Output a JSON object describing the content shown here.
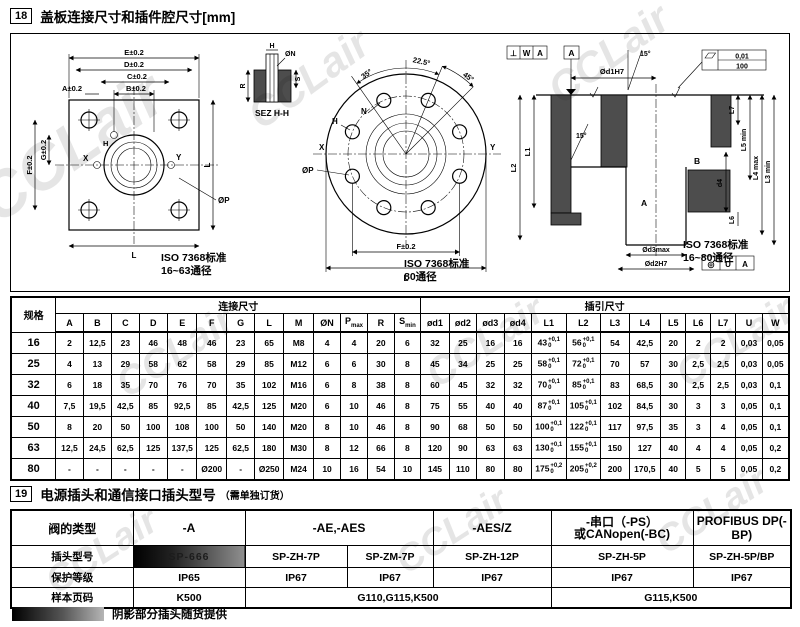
{
  "watermark": "CCLair",
  "header18": {
    "num": "18",
    "title": "盖板连接尺寸和插件腔尺寸[mm]"
  },
  "header19": {
    "num": "19",
    "title": "电源插头和通信接口插头型号",
    "subtitle": "（需单独订货）"
  },
  "figures": {
    "fig1": {
      "E": "E±0.2",
      "D": "D±0.2",
      "C": "C±0.2",
      "B": "B±0.2",
      "A": "A±0.2",
      "F": "F±0.2",
      "G": "G±0.2",
      "H": "H",
      "Lr": "L",
      "Lb": "L",
      "X": "X",
      "Y": "Y",
      "P": "ØP",
      "caption1": "ISO 7368标准",
      "caption2": "16~63通径",
      "sez": {
        "title": "SEZ H-H",
        "H": "H",
        "N": "ØN",
        "R": "R",
        "S": "S"
      }
    },
    "fig2": {
      "a35": "35°",
      "a225": "22.5°",
      "a45": "45°",
      "H": "H",
      "N": "N",
      "X": "X",
      "Y": "Y",
      "P": "ØP",
      "F": "F±0.2",
      "L": "L",
      "caption1": "ISO 7368标准",
      "caption2": "80通径"
    },
    "fig3": {
      "d1": "Ød1H7",
      "datumA": "A",
      "perp": "⊥",
      "W": "W",
      "dA2": "A",
      "conc": "◎",
      "U": "U",
      "dA3": "A",
      "flat1": "0,01",
      "flat2": "100",
      "a15a": "15°",
      "a15b": "15°",
      "L1": "L1",
      "L2": "L2",
      "L3": "L3 min",
      "L4": "L4 max",
      "L5": "L5 min",
      "L7": "L7",
      "d4": "d4",
      "L6": "L6",
      "B": "B",
      "A": "A",
      "d3": "Ød3max",
      "d2": "Ød2H7",
      "caption1": "ISO 7368标准",
      "caption2": "16~80通径"
    }
  },
  "table1": {
    "spec": "规格",
    "group1": "连接尺寸",
    "group2": "插引尺寸",
    "columns": [
      "A",
      "B",
      "C",
      "D",
      "E",
      "F",
      "G",
      "L",
      "M",
      "ØN",
      [
        "P",
        "max"
      ],
      "R",
      [
        "S",
        "min"
      ],
      "ød1",
      "ød2",
      "ød3",
      "ød4",
      "L1",
      "L2",
      "L3",
      "L4",
      "L5",
      "L6",
      "L7",
      "U",
      "W"
    ],
    "rows": [
      {
        "spec": "16",
        "v": [
          "2",
          "12,5",
          "23",
          "46",
          "48",
          "46",
          "23",
          "65",
          "M8",
          "4",
          "4",
          "20",
          "6",
          "32",
          "25",
          "16",
          "16",
          [
            "43",
            "+0,1",
            "0"
          ],
          [
            "56",
            "+0,1",
            "0"
          ],
          "54",
          "42,5",
          "20",
          "2",
          "2",
          "0,03",
          "0,05"
        ]
      },
      {
        "spec": "25",
        "v": [
          "4",
          "13",
          "29",
          "58",
          "62",
          "58",
          "29",
          "85",
          "M12",
          "6",
          "6",
          "30",
          "8",
          "45",
          "34",
          "25",
          "25",
          [
            "58",
            "+0,1",
            "0"
          ],
          [
            "72",
            "+0,1",
            "0"
          ],
          "70",
          "57",
          "30",
          "2,5",
          "2,5",
          "0,03",
          "0,05"
        ]
      },
      {
        "spec": "32",
        "v": [
          "6",
          "18",
          "35",
          "70",
          "76",
          "70",
          "35",
          "102",
          "M16",
          "6",
          "8",
          "38",
          "8",
          "60",
          "45",
          "32",
          "32",
          [
            "70",
            "+0,1",
            "0"
          ],
          [
            "85",
            "+0,1",
            "0"
          ],
          "83",
          "68,5",
          "30",
          "2,5",
          "2,5",
          "0,03",
          "0,1"
        ]
      },
      {
        "spec": "40",
        "v": [
          "7,5",
          "19,5",
          "42,5",
          "85",
          "92,5",
          "85",
          "42,5",
          "125",
          "M20",
          "6",
          "10",
          "46",
          "8",
          "75",
          "55",
          "40",
          "40",
          [
            "87",
            "+0,1",
            "0"
          ],
          [
            "105",
            "+0,1",
            "0"
          ],
          "102",
          "84,5",
          "30",
          "3",
          "3",
          "0,05",
          "0,1"
        ]
      },
      {
        "spec": "50",
        "v": [
          "8",
          "20",
          "50",
          "100",
          "108",
          "100",
          "50",
          "140",
          "M20",
          "8",
          "10",
          "46",
          "8",
          "90",
          "68",
          "50",
          "50",
          [
            "100",
            "+0,1",
            "0"
          ],
          [
            "122",
            "+0,1",
            "0"
          ],
          "117",
          "97,5",
          "35",
          "3",
          "4",
          "0,05",
          "0,1"
        ]
      },
      {
        "spec": "63",
        "v": [
          "12,5",
          "24,5",
          "62,5",
          "125",
          "137,5",
          "125",
          "62,5",
          "180",
          "M30",
          "8",
          "12",
          "66",
          "8",
          "120",
          "90",
          "63",
          "63",
          [
            "130",
            "+0,1",
            "0"
          ],
          [
            "155",
            "+0,1",
            "0"
          ],
          "150",
          "127",
          "40",
          "4",
          "4",
          "0,05",
          "0,2"
        ]
      },
      {
        "spec": "80",
        "v": [
          "-",
          "-",
          "-",
          "-",
          "-",
          "Ø200",
          "-",
          "Ø250",
          "M24",
          "10",
          "16",
          "54",
          "10",
          "145",
          "110",
          "80",
          "80",
          [
            "175",
            "+0,2",
            "0"
          ],
          [
            "205",
            "+0,2",
            "0"
          ],
          "200",
          "170,5",
          "40",
          "5",
          "5",
          "0,05",
          "0,2"
        ]
      }
    ]
  },
  "table2": {
    "row_labels": [
      "阀的类型",
      "插头型号",
      "保护等级",
      "样本页码"
    ],
    "types": [
      {
        "t": "-A",
        "span": 1
      },
      {
        "t": "-AE,-AES",
        "span": 2
      },
      {
        "t": "-AES/Z",
        "span": 1
      },
      {
        "t": "-串口（-PS）",
        "t2": "或CANopen(-BC)",
        "span": 1
      },
      {
        "t": "PROFIBUS DP(-BP)",
        "span": 1
      }
    ],
    "models": [
      {
        "t": "SP-666",
        "shaded": true
      },
      {
        "t": "SP-ZH-7P"
      },
      {
        "t": "SP-ZM-7P"
      },
      {
        "t": "SP-ZH-12P"
      },
      {
        "t": "SP-ZH-5P"
      },
      {
        "t": "SP-ZH-5P/BP"
      }
    ],
    "protection": [
      "IP65",
      "IP67",
      "IP67",
      "IP67",
      "IP67",
      "IP67"
    ],
    "pages": [
      {
        "t": "K500",
        "span": 1
      },
      {
        "t": "G110,G115,K500",
        "span": 3
      },
      {
        "t": "G115,K500",
        "span": 2
      }
    ]
  },
  "note": "阴影部分插头随货提供"
}
